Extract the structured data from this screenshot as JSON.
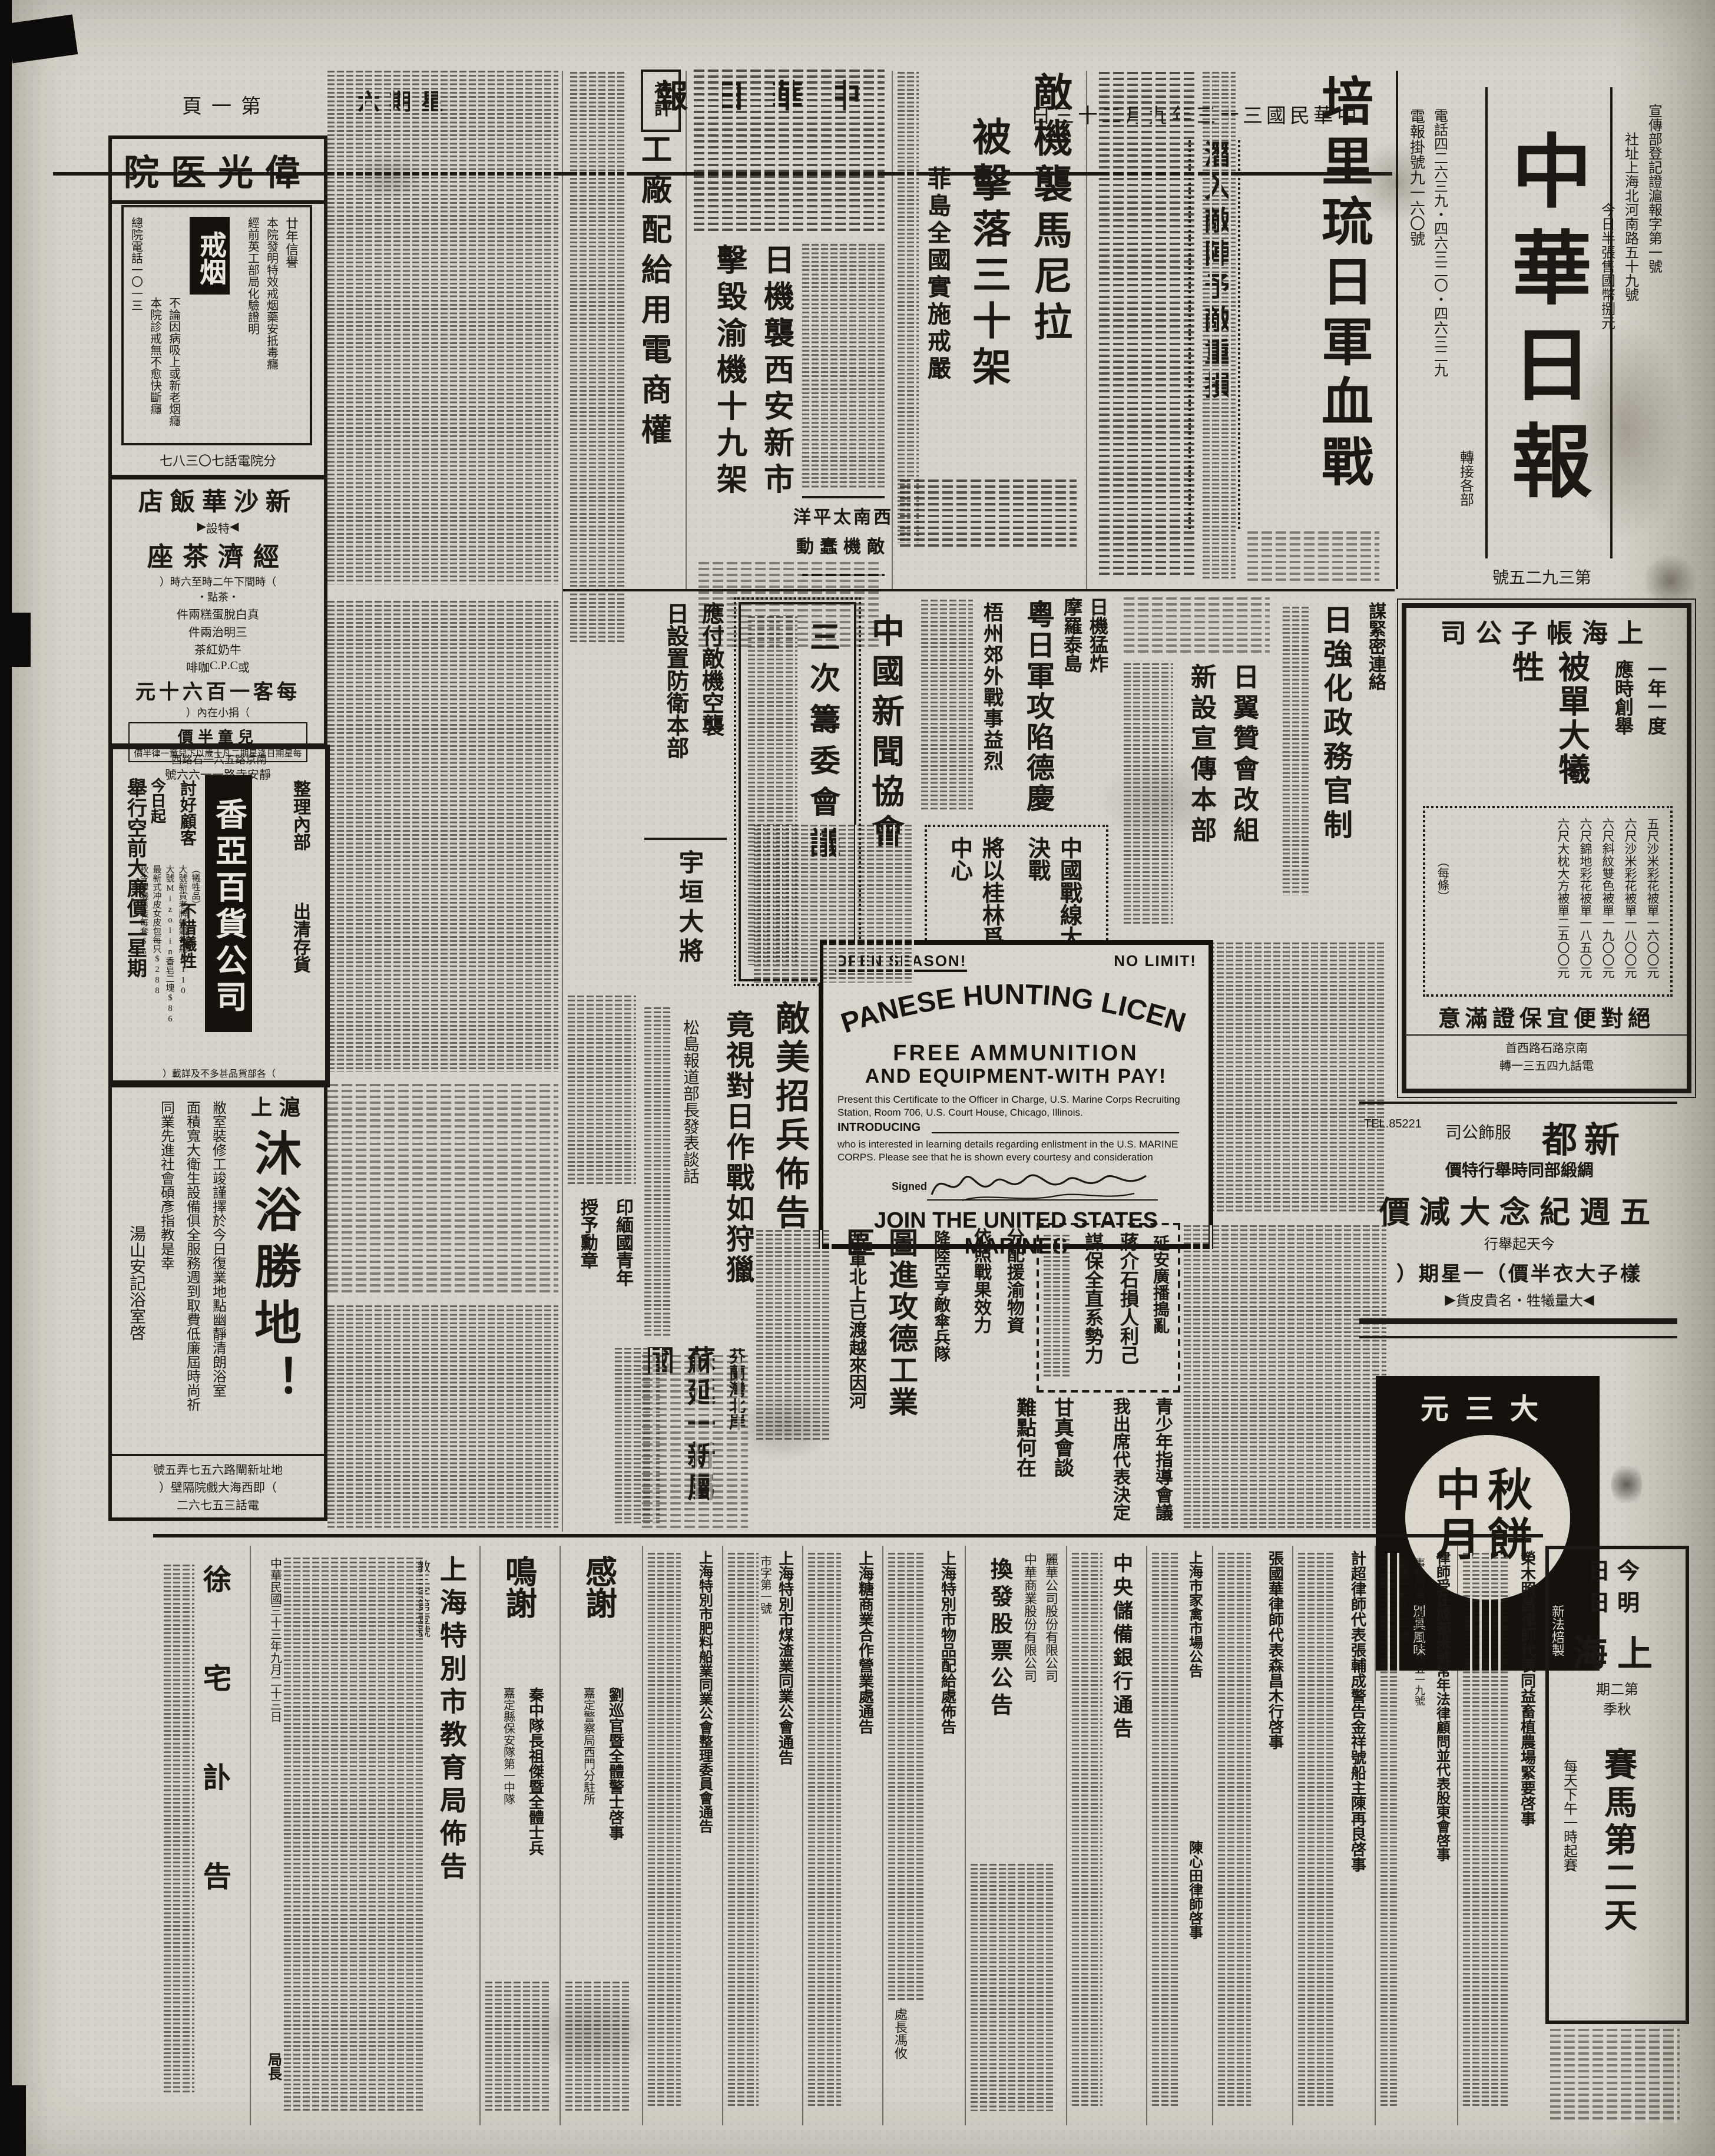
{
  "page": {
    "page_label": "第一頁",
    "weekday": "星期六",
    "paper_name_small": "中華日報",
    "date_line": "中華民國三十三年九月二十三日"
  },
  "masthead": {
    "title": "中華日報",
    "registration": "宣傳部登記證滬報字第一號",
    "address": "社址上海北河南路五十九號",
    "price_note": "今日半張售國幣捌元",
    "telegraph": "電報掛號九一六〇號",
    "phones": "電話四二六三九・四六三二〇・四六三二九",
    "phone_note": "轉接各部",
    "issue_no": "第三九二五號"
  },
  "editorial": {
    "label": "社評",
    "title": "工廠配給用電商權"
  },
  "news": {
    "peleliu": {
      "title": "培里琉日軍血戰",
      "subtitle": "潛入敵陣予敵重損",
      "dateline": "【中央社南京二十二日電】"
    },
    "manila": {
      "title": "敵機襲馬尼拉",
      "subtitle": "被擊落三十架",
      "kicker": "菲島全國實施戒嚴"
    },
    "xian": {
      "title": "日機襲西安新市",
      "subtitle": "擊毀渝機十九架",
      "kicker_line1": "西南太平洋",
      "kicker_line2": "敵機蠢動"
    },
    "morotai": {
      "line1": "日機猛炸",
      "line2": "摩羅泰島"
    },
    "deqing": {
      "title": "粵日軍攻陷德慶",
      "subtitle": "梧州郊外戰事益烈"
    },
    "press_assoc": {
      "org": "中國新聞協會",
      "title": "三次籌委會議"
    },
    "air_defense": {
      "line1": "應付敵機空襲",
      "line2": "日設置防衛本部"
    },
    "gov_reform": {
      "kicker": "謀緊密連絡",
      "title": "日強化政務官制"
    },
    "yokusan": {
      "line1": "日翼贊會改組",
      "line2": "新設宣傳本部"
    },
    "guilin": {
      "line1": "中國戰線大決戰",
      "line2": "將以桂林爲中心"
    },
    "execution": {
      "line1": "渝守全縣司令",
      "line2": "被處死刑"
    },
    "marines_notice": {
      "title": "敵美招兵佈告",
      "subtitle": "竟視對日作戰如狩獵",
      "note": "松島報道部長發表談話"
    },
    "ugaki": {
      "title": "宇垣大將"
    },
    "medal": {
      "line1": "印緬國青年",
      "line2": "授予勳章"
    },
    "arnhem": {
      "kicker": "降陸亞亨敵傘兵隊",
      "title": "圖進攻德工業區",
      "subtitle": "英軍北上已渡越來因河"
    },
    "finland": {
      "kicker": "芬蘭灣北岸",
      "title": "蘇延一新屬國"
    },
    "yanan": {
      "kicker": "延安廣播搗亂",
      "line1": "蔣介石損人利己",
      "line2": "謀保全直系勢力"
    },
    "supplies": {
      "line1": "分配援渝物資",
      "line2": "依照戰果效力"
    },
    "youth": {
      "line1": "青少年指導會議",
      "line2": "我出席代表決定"
    },
    "gandhi": {
      "line1": "甘真會談",
      "line2": "難點何在"
    }
  },
  "english_ad": {
    "open": "OPEN SEASON!",
    "no_limit": "NO LIMIT!",
    "arc_title": "JAPANESE HUNTING LICENSE",
    "line1": "FREE AMMUNITION",
    "line2": "AND EQUIPMENT-WITH PAY!",
    "para1": "Present this Certificate to the Officer in Charge, U.S. Marine Corps Recruiting Station, Room 706, U.S. Court House, Chicago, Illinois.",
    "introducing": "INTRODUCING",
    "para2": "who is interested in learning details regarding enlistment in the U.S. MARINE CORPS. Please see that he is shown every courtesy and consideration",
    "signed": "Signed",
    "footer": "JOIN THE UNITED STATES MARINES"
  },
  "ads": {
    "weiguang": {
      "name": "偉光医院",
      "product": "戒烟",
      "trust": "廿年信譽",
      "line1": "本院發明特效戒烟藥安抵毒癮",
      "line2": "經前英工部局化驗證明",
      "line3": "不論因病吸上或新老烟癮",
      "line4": "本院診戒無不愈快斷癮",
      "phone1": "總院電話一〇一三",
      "phone2": "分院電話七〇三八七"
    },
    "xinshahua": {
      "name": "新沙華飯店",
      "special": "◀特設▶",
      "product": "經濟茶座",
      "time": "（時間下午二時至六時）",
      "menu_label": "・茶點・",
      "menu1": "真白脫蛋糕兩件",
      "menu2": "三明治兩件",
      "menu3": "牛奶紅茶",
      "menu4": "或C.P.C咖啡",
      "price": "每客一百六十元",
      "price_note": "（捐小在內）",
      "kids": "兒童半價",
      "kids_note": "每星期日逢星期二凡十歲以下兒童一律半價",
      "address": "靜安寺路一一六六號"
    },
    "xiangya": {
      "location": "南京路五六一石路西",
      "name": "香亞百貨公司",
      "promo1": "今日起",
      "promo2": "舉行空前大廉價二星期",
      "slogan1": "討好顧客",
      "slogan2": "不惜犧牲",
      "clear1": "整理內部",
      "clear2": "出清存貨",
      "cat1": "（犧牲品）",
      "item1": "大號新貨老牌蜂霜每瓶$110",
      "item2": "大號Mizolin香皂二塊$86",
      "item3": "最新式冲皮女皮包每只$288",
      "item4": "秋令嗶嘰男裝每套$650",
      "item5": "真絲提花全白綢襯衫每件$1000",
      "item6": "鴻興老牌四十二支夾底男襪二雙$250.00",
      "item7": "條口真絲男套襪二雙$150",
      "cat2": "（綢緞部）",
      "item8": "條子美琪絹每丈$400每人限購一丈",
      "item9": "全部綢緞衣料一律照碼九折",
      "cat3": "（皮鞋部）",
      "item10": "助式女牛皮鞋每雙自五百元起",
      "note": "（各部貨品甚多不及詳載）"
    },
    "bath": {
      "kicker": "滬上",
      "title": "沐浴勝地！",
      "body1": "敝室裝修工竣謹擇於今日復業地點幽靜清朗浴室",
      "body2": "面積寬大衛生設備俱全服務週到取費低廉屆時尚祈",
      "body3": "同業先進社會碩彥指教是幸",
      "sign": "湯山安記浴室啓",
      "addr1": "地址新閘路六五七弄五號",
      "addr2": "（即西海大戲院隔壁）",
      "addr3": "電話三五七六二"
    },
    "zhangzi": {
      "name": "上海帳子公司",
      "k1": "一年一度",
      "k2": "應時創舉",
      "big": "被單大犧牲",
      "item1": "五尺沙米彩花被單一六〇〇元",
      "item2": "六尺沙米彩花被單一八〇〇元",
      "item3": "六尺斜紋雙色被單一九〇〇元",
      "item4": "六尺錦地彩花被單一八五〇元",
      "item5": "六尺大枕大方被單二五〇〇元",
      "each": "（每條）",
      "slogan": "絕對便宜保證滿意",
      "address": "南京路石路西首",
      "phone": "電話九四五三一轉"
    },
    "xindu": {
      "name": "新都",
      "name2": "服飾公司",
      "l1": "綢緞部同時舉行特價",
      "l2": "五週紀念大減價",
      "l3": "今天起舉行",
      "l4": "樣子大衣半價（一星期）",
      "l5": "◀大量犧牲・名貴皮貨▶",
      "tel": "TEL.85221"
    },
    "mooncake": {
      "brand": "大三元",
      "product": "中秋月餅",
      "note1": "新法焙製",
      "note2": "別具風味"
    },
    "racing": {
      "day1": "今日",
      "day2": "明日",
      "city": "上海",
      "term": "第二期",
      "season": "秋季",
      "title": "賽馬第二天",
      "time": "每天下午一時起賽"
    }
  },
  "notices": {
    "rongmu": "榮木照昌律師代表同益畜植農場緊要啓事",
    "chengdu": {
      "title": "律師受任成都米號常年法律顧問並代表股東會啓事",
      "office": "事務所南京路哈同大樓五一九號",
      "phone": "電話一七八二一號"
    },
    "jichao": "計超律師代表張輔成警告金祥號船主陳再良啓事",
    "zhangguohua": "張國華律師代表森昌木行啓事",
    "poultry": "上海市家禽市場公告",
    "chenxintian": "陳心田律師啓事",
    "bank": "中央儲備銀行通告",
    "stock": {
      "co1": "麗華公司股份有限公司",
      "co2": "中華商業股份有限公司",
      "title": "換發股票公告"
    },
    "rations": {
      "title": "上海特別市物品配給處佈告",
      "sign": "處長馮攸"
    },
    "sugar": "上海糖商業合作營業處通告",
    "coal": {
      "title": "上海特別市煤渣業同業公會通告",
      "no": "市字第一號"
    },
    "fertilizer": "上海特別市肥料船業同業公會整理委員會通告",
    "thanks1": {
      "title": "感謝",
      "sub": "嘉定警察局西門分駐所",
      "name": "劉巡官暨全體警士啓事"
    },
    "thanks2": {
      "title": "鳴謝",
      "sub": "嘉定縣保安隊第一中隊",
      "name": "秦中隊長祖傑暨全體士兵"
    },
    "education": {
      "title": "上海特別市教育局佈告",
      "no": "教三字第壹號",
      "date": "中華民國三十三年九月二十三日",
      "sign": "局長"
    },
    "obituary": "徐宅訃告"
  }
}
